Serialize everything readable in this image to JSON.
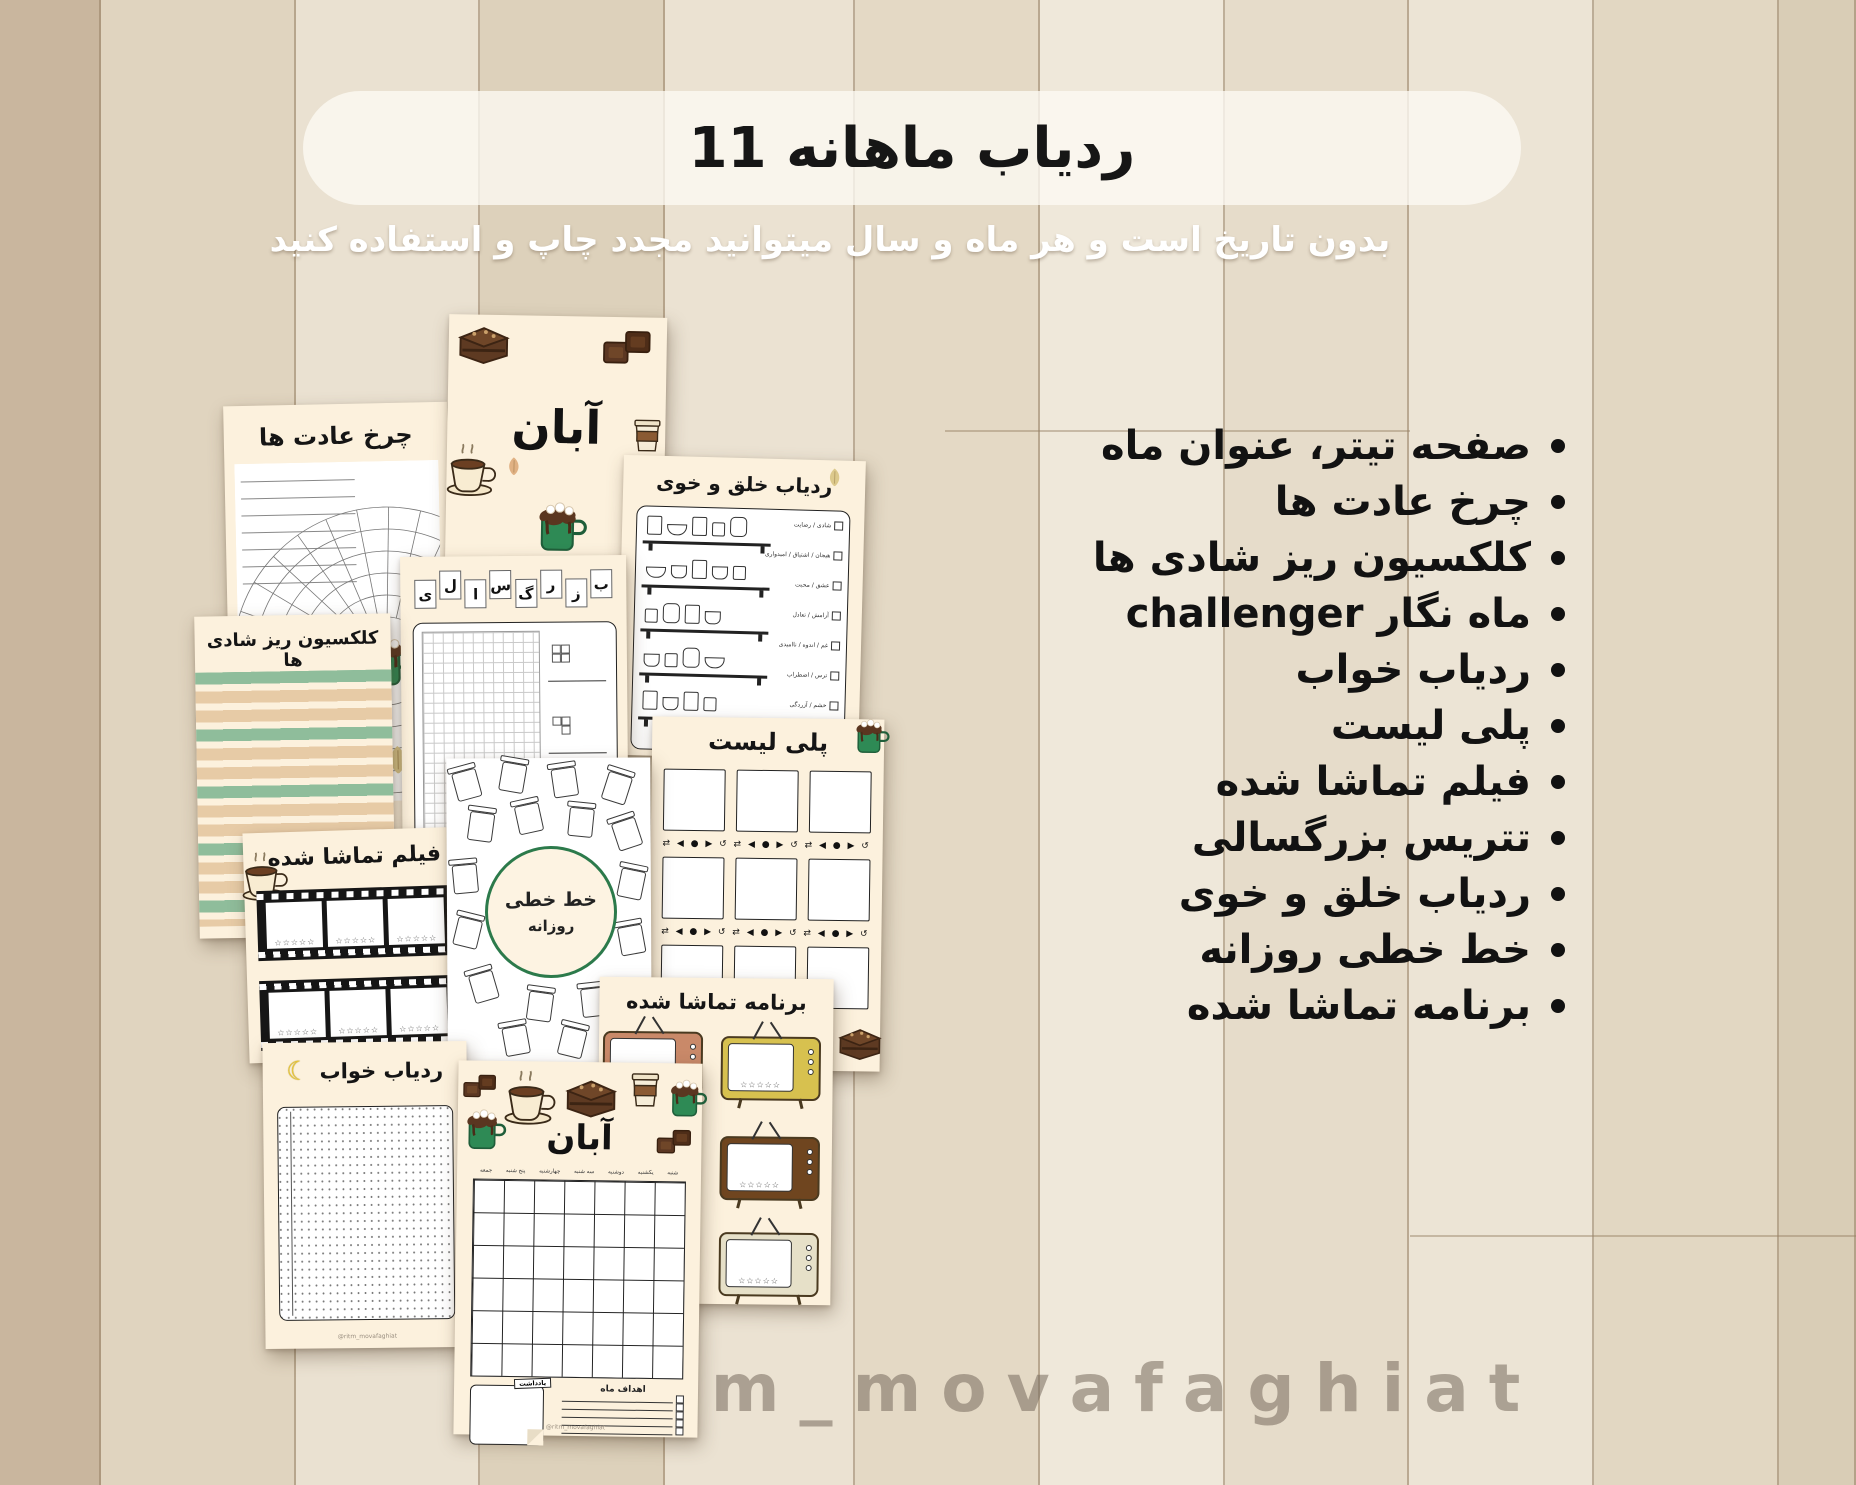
{
  "banner": {
    "title": "11 ردیاب ماهانه"
  },
  "subtitle": "بدون تاریخ است و هر ماه و سال میتوانید مجدد چاپ و استفاده کنید",
  "features": [
    "صفحه تیتر، عنوان ماه",
    "چرخ عادت ها",
    "کلکسیون ریز شادی ها",
    "ماه نگار challenger",
    "ردیاب خواب",
    "پلی لیست",
    "فیلم تماشا شده",
    "تتریس بزرگسالی",
    "ردیاب خلق و خوی",
    "خط خطی روزانه",
    "برنامه تماشا شده"
  ],
  "watermark": "@ritm_movafaghiat",
  "icons": {
    "crescent-moon": "☾",
    "star-outline": "☆",
    "player-controls": "⇄ ◀ ● ▶ ↺"
  },
  "colors": {
    "page_cream": "#fcf1dd",
    "green": "#2e8a55",
    "stripe_green": "#8fbd9b",
    "stripe_tan": "#e7cba6",
    "chocolate": "#5b3722"
  },
  "pages": {
    "habit_wheel": {
      "title": "چرخ عادت ها"
    },
    "month_cover": {
      "title": "آبان"
    },
    "mood_tracker": {
      "title": "ردیاب خلق و خوی",
      "moods": [
        "شادی / رضایت",
        "هیجان / اشتیاق / امیدواری",
        "عشق / محبت",
        "آرامش / تعادل",
        "غم / اندوه / ناامیدی",
        "ترس / اضطراب",
        "خشم / آزردگی"
      ]
    },
    "tetris": {
      "letters": [
        "ب",
        "ز",
        "ر",
        "گ",
        "س",
        "ا",
        "ل",
        "ی"
      ]
    },
    "joys": {
      "title": "کلکسیون ریز شادی ها"
    },
    "playlist": {
      "title": "پلی لیست",
      "controls_row": "⇄ ◀ ● ▶ ↺   ⇄ ◀ ● ▶ ↺   ⇄ ◀ ● ▶ ↺"
    },
    "doodle": {
      "title_line1": "خط خطی",
      "title_line2": "روزانه"
    },
    "movies": {
      "title": "فیلم تماشا شده",
      "stars": "☆☆☆☆☆"
    },
    "sleep": {
      "title": "ردیاب خواب"
    },
    "shows": {
      "title": "برنامه تماشا شده",
      "stars": "☆☆☆☆☆"
    },
    "calendar": {
      "title": "آبان",
      "weekdays": [
        "شنبه",
        "یکشنبه",
        "دوشنبه",
        "سه شنبه",
        "چهارشنبه",
        "پنج شنبه",
        "جمعه"
      ],
      "notes_label": "یادداشت",
      "goals_label": "اهداف ماه"
    }
  }
}
